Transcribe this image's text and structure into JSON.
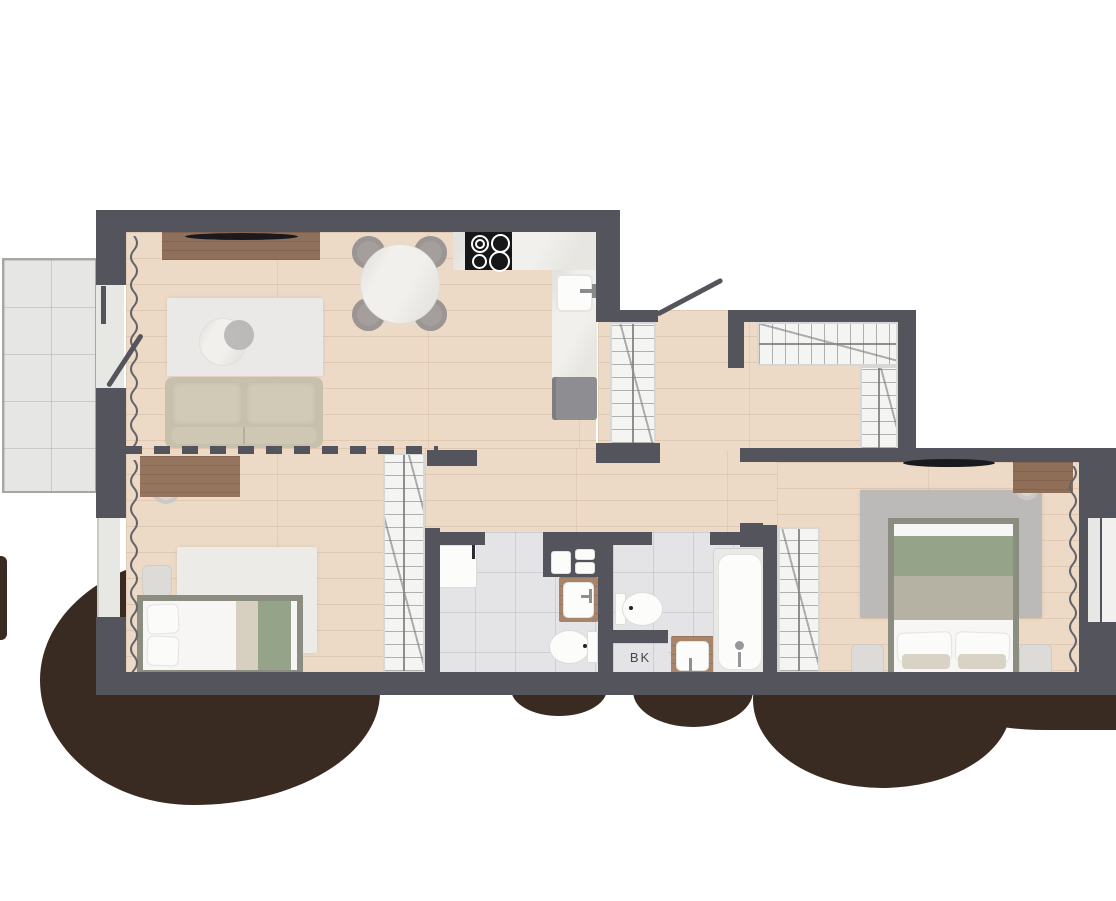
{
  "type": "apartment-floor-plan",
  "labels": {
    "shaft": "BK"
  },
  "colors": {
    "wall": "#54545c",
    "wood_floor": "#ecd9c6",
    "bath_tile": "#e4e4e7",
    "balcony_tile": "#e6e6e4",
    "counter_marble": "#f1f0ec",
    "cooktop": "#17171a",
    "furniture_wood": "#926f59",
    "sofa": "#c6c0ad",
    "bed_frame": "#8a8d80",
    "blanket_green": "#95a489",
    "rug_light": "#eae9e7",
    "rug_gray": "#bbbab8",
    "appliance_gray": "#8e8e92",
    "tree_shadow": "#392b21",
    "closet_fill": "#f4f4f3",
    "hatch_line": "#8f8f8f"
  },
  "rooms": [
    {
      "name": "living-room-kitchen",
      "furniture": [
        "tv-sideboard",
        "wall-tv",
        "sofa",
        "coffee-table",
        "rug",
        "round-dining-table",
        "dining-chair-1",
        "dining-chair-2",
        "dining-chair-3",
        "dining-chair-4",
        "kitchen-counter",
        "cooktop-4-burners",
        "kitchen-sink",
        "refrigerator",
        "curtain"
      ]
    },
    {
      "name": "hallway",
      "furniture": [
        "entrance-door",
        "tall-wardrobe",
        "corner-wardrobe"
      ]
    },
    {
      "name": "bedroom-1",
      "furniture": [
        "desk",
        "desk-chair",
        "bed",
        "nightstand",
        "rug",
        "wardrobe",
        "curtain"
      ]
    },
    {
      "name": "bedroom-2",
      "furniture": [
        "double-bed",
        "nightstand-left",
        "nightstand-right",
        "rug",
        "desk",
        "desk-chair",
        "wardrobe",
        "wall-tv",
        "curtain"
      ]
    },
    {
      "name": "bathroom-1",
      "furniture": [
        "washing-machine",
        "stacked-washer-dryer",
        "vanity-sink",
        "toilet"
      ]
    },
    {
      "name": "bathroom-2",
      "furniture": [
        "toilet",
        "vanity-sink",
        "bathtub"
      ]
    },
    {
      "name": "balcony",
      "furniture": []
    },
    {
      "name": "shaft",
      "label": "BK"
    }
  ],
  "openings": {
    "doors": [
      "entrance-door",
      "balcony-door",
      "bathroom-1-opening",
      "bathroom-2-opening",
      "bedroom-2-opening"
    ],
    "windows": [
      "balcony-door-glazing",
      "bedroom-1-window",
      "bedroom-2-window"
    ]
  }
}
